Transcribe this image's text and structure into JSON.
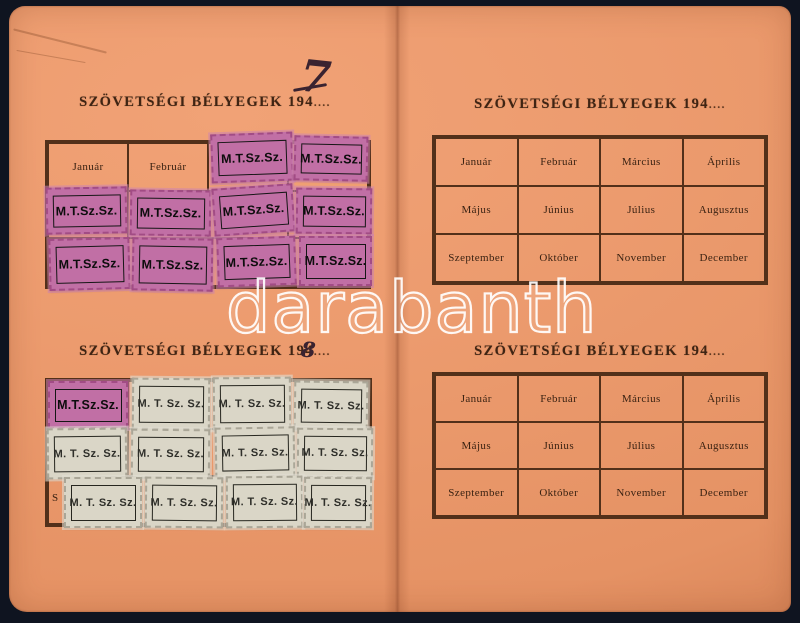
{
  "watermark": {
    "text": "darabanth"
  },
  "months": [
    "Január",
    "Február",
    "Március",
    "Április",
    "Május",
    "Június",
    "Július",
    "Augusztus",
    "Szeptember",
    "Október",
    "November",
    "December"
  ],
  "sections": {
    "top_left": {
      "title": "SZÖVETSÉGI BÉLYEGEK 194",
      "dots": "....",
      "handwritten_year": "7"
    },
    "top_right": {
      "title": "SZÖVETSÉGI BÉLYEGEK 194",
      "dots": "...."
    },
    "bottom_left": {
      "title": "SZÖVETSÉGI BÉLYEGEK 194",
      "dots": "....",
      "handwritten_year": "8",
      "peeking_letter": "S"
    },
    "bottom_right": {
      "title": "SZÖVETSÉGI BÉLYEGEK 194",
      "dots": "...."
    }
  },
  "stamps": {
    "purple_label": "M.T.Sz.Sz.",
    "white_label": "M. T. Sz. Sz."
  },
  "colors": {
    "paper": "#EC9B6E",
    "background": "#0F1420",
    "table_line": "#52301A",
    "stamp_purple": "#C16FA5",
    "stamp_white": "#DAD6C7",
    "title_ink": "#3F2413",
    "watermark_stroke": "#FFFFFF"
  }
}
